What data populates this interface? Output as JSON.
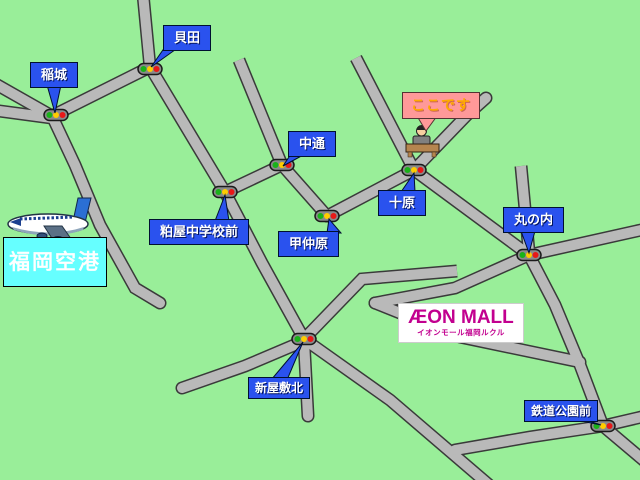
{
  "map": {
    "callouts": {
      "inagi": "稲城",
      "kaida": "貝田",
      "nakadori": "中通",
      "juhara": "十原",
      "konakabaru": "甲仲原",
      "marunouchi": "丸の内",
      "kasuya_jhs_mae": "粕屋中学校前",
      "shinyashiki_kita": "新屋敷北",
      "tetsudo_koen_mae": "鉄道公園前",
      "here": "ここです"
    },
    "airport": {
      "label": "福岡空港"
    },
    "destination": {
      "logo": "ÆON MALL",
      "logo_sub": "イオンモール福岡ルクル"
    },
    "icons": {
      "airplane": "airplane-icon",
      "traffic_light": "traffic-light-icon",
      "building": "destination-building-icon"
    },
    "colors": {
      "background": "#99ee99",
      "road_fill": "#b9b9b9",
      "road_casing": "#3a3a3a",
      "callout_blue": "#2a52ee",
      "callout_pink": "#ff9999",
      "here_text": "#ffaa00",
      "airport_sign_fill": "#66ffff",
      "logo_magenta": "#c2008f",
      "signal_green": "#19b219",
      "signal_yellow": "#ffcc00",
      "signal_red": "#e81818"
    }
  }
}
